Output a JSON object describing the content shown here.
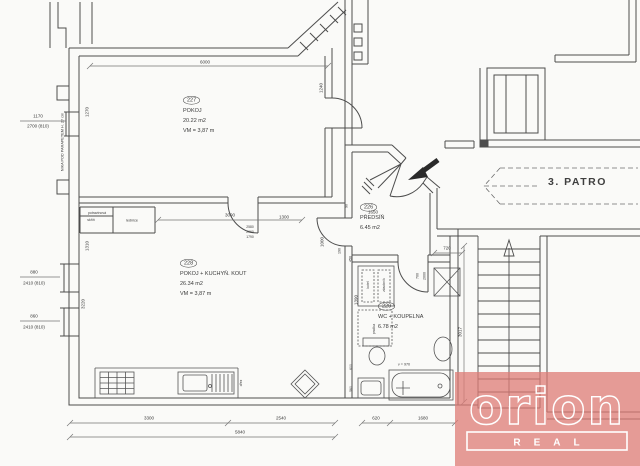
{
  "page": {
    "paper": "#fafaf8",
    "ink": "#4d4d4d"
  },
  "floor": {
    "label": "3. PATRO"
  },
  "rooms": [
    {
      "number": "227",
      "name": "POKOJ",
      "area": "20.22 m2",
      "height": "VM = 3,87 m"
    },
    {
      "number": "228",
      "name": "POKOJ + KUCHYŇ. KOUT",
      "area": "26.34 m2",
      "height": "VM = 3,87 m"
    },
    {
      "number": "226",
      "name": "PŘEDSÍŇ",
      "area": "6.45 m2"
    },
    {
      "number": "229",
      "name": "WC + KOUPELNA",
      "area": "6.78 m2"
    }
  ],
  "logo": {
    "brand": "orion",
    "sub": "REAL",
    "color": "#dd7b76"
  },
  "labels": [
    {
      "id": "dim-top-6000",
      "t": "6000",
      "x": 205,
      "y": 62
    },
    {
      "id": "dim-227-left-1270",
      "t": "1270",
      "x": 87,
      "y": 112,
      "r": -90
    },
    {
      "id": "dim-227-right-1240",
      "t": "1240",
      "x": 321,
      "y": 88,
      "r": -90
    },
    {
      "id": "dim-window-1170",
      "t": "1170",
      "x": 38,
      "y": 116
    },
    {
      "id": "dim-window-2700",
      "t": "2700 (810)",
      "x": 38,
      "y": 126
    },
    {
      "id": "note-nika",
      "t": "NIKA POD PARAPETEM H. 27 cm",
      "x": 62,
      "y": 142,
      "r": -90,
      "fs": 3.8
    },
    {
      "id": "dim-door-880",
      "t": "880",
      "x": 34,
      "y": 272
    },
    {
      "id": "dim-door-2410-a",
      "t": "2410 (810)",
      "x": 34,
      "y": 283
    },
    {
      "id": "dim-door-860",
      "t": "860",
      "x": 34,
      "y": 316
    },
    {
      "id": "dim-door-2410-b",
      "t": "2410 (810)",
      "x": 34,
      "y": 327
    },
    {
      "id": "note-pantry-1",
      "t": "potravinová",
      "x": 97,
      "y": 213,
      "fs": 3.5
    },
    {
      "id": "note-pantry-2",
      "t": "skříň",
      "x": 91,
      "y": 220,
      "fs": 3.5
    },
    {
      "id": "note-fridge",
      "t": "lednice",
      "x": 132,
      "y": 220,
      "fs": 3.8
    },
    {
      "id": "dim-3090",
      "t": "3090",
      "x": 230,
      "y": 215
    },
    {
      "id": "dim-1300",
      "t": "1300",
      "x": 284,
      "y": 217
    },
    {
      "id": "dim-2580",
      "t": "2580",
      "x": 250,
      "y": 227,
      "fs": 3.4
    },
    {
      "id": "dim-2060",
      "t": "2060",
      "x": 250,
      "y": 232,
      "fs": 3.4
    },
    {
      "id": "dim-1790",
      "t": "1790",
      "x": 250,
      "y": 237,
      "fs": 3.4
    },
    {
      "id": "dim-1650",
      "t": "1650",
      "x": 373,
      "y": 212
    },
    {
      "id": "dim-90",
      "t": "90",
      "x": 346,
      "y": 206,
      "r": -90,
      "fs": 3.6
    },
    {
      "id": "dim-1000",
      "t": "1000",
      "x": 322,
      "y": 242,
      "r": -90
    },
    {
      "id": "dim-190",
      "t": "190",
      "x": 339,
      "y": 251,
      "r": -90,
      "fs": 3.6
    },
    {
      "id": "dim-1310",
      "t": "1310",
      "x": 87,
      "y": 246,
      "r": -90
    },
    {
      "id": "dim-3220",
      "t": "3220",
      "x": 83,
      "y": 304,
      "r": -90
    },
    {
      "id": "dim-450",
      "t": "450",
      "x": 350,
      "y": 259,
      "r": -90,
      "fs": 3.6
    },
    {
      "id": "dim-700",
      "t": "700",
      "x": 417,
      "y": 276,
      "r": -90,
      "fs": 3.6
    },
    {
      "id": "dim-2000",
      "t": "2000",
      "x": 424,
      "y": 276,
      "r": -90,
      "fs": 3.6
    },
    {
      "id": "dim-1390",
      "t": "1390",
      "x": 356,
      "y": 300,
      "r": -90
    },
    {
      "id": "note-boiler",
      "t": "kotel",
      "x": 368,
      "y": 285,
      "r": -90,
      "fs": 3.4
    },
    {
      "id": "note-tank",
      "t": "zásobník",
      "x": 384,
      "y": 285,
      "r": -90,
      "fs": 3.4
    },
    {
      "id": "note-washer",
      "t": "pračka",
      "x": 374,
      "y": 329,
      "r": -90,
      "fs": 3.4
    },
    {
      "id": "note-sink-drez",
      "t": "dřez",
      "x": 241,
      "y": 383,
      "r": -90,
      "fs": 3.4
    },
    {
      "id": "note-height-970",
      "t": "v = 970",
      "x": 404,
      "y": 364,
      "fs": 3.7
    },
    {
      "id": "dim-600",
      "t": "600",
      "x": 351,
      "y": 367,
      "r": -90,
      "fs": 3.4
    },
    {
      "id": "dim-560",
      "t": "560",
      "x": 351,
      "y": 389,
      "r": -90,
      "fs": 3.4
    },
    {
      "id": "dim-720",
      "t": "720",
      "x": 447,
      "y": 248
    },
    {
      "id": "dim-3017",
      "t": "3017",
      "x": 460,
      "y": 332,
      "r": -90
    },
    {
      "id": "dim-3300",
      "t": "3300",
      "x": 149,
      "y": 418
    },
    {
      "id": "dim-2540",
      "t": "2540",
      "x": 281,
      "y": 418
    },
    {
      "id": "dim-5840",
      "t": "5840",
      "x": 240,
      "y": 432
    },
    {
      "id": "dim-620",
      "t": "620",
      "x": 376,
      "y": 418
    },
    {
      "id": "dim-1680",
      "t": "1680",
      "x": 423,
      "y": 418
    }
  ]
}
